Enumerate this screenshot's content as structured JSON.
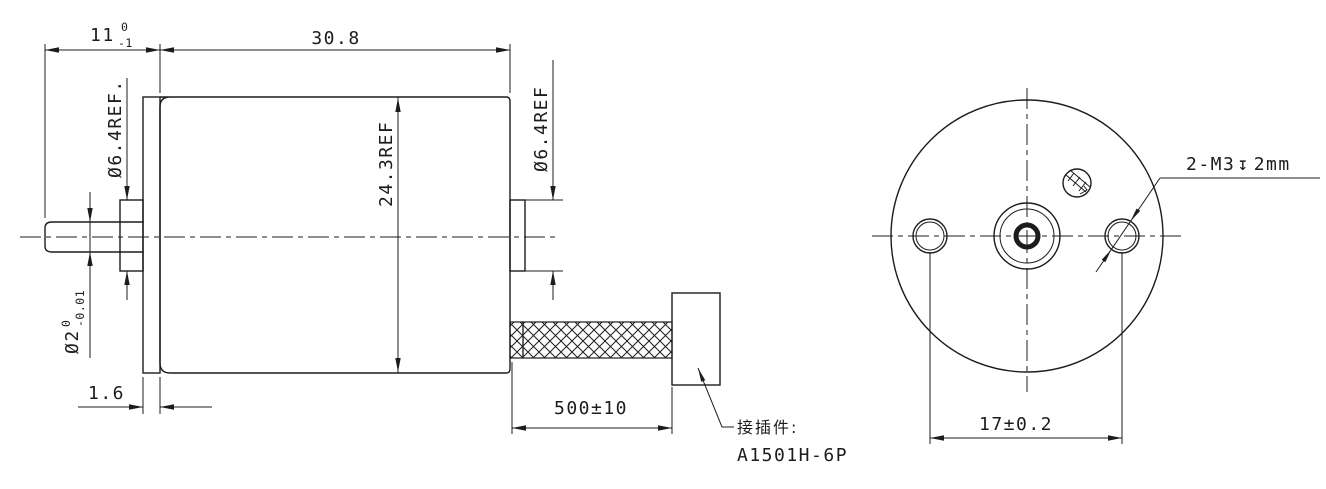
{
  "side_view": {
    "dim_shaft_protrusion": {
      "nominal": "11",
      "upper": "0",
      "lower": "-1"
    },
    "dim_body_length": "30.8",
    "dim_front_boss_dia": "Ø6.4REF.",
    "dim_body_dia": "24.3REF",
    "dim_rear_boss_dia": "Ø6.4REF",
    "dim_shaft_dia": {
      "nominal": "Ø2",
      "upper": "0",
      "lower": "-0.01"
    },
    "dim_flange_thickness": "1.6",
    "dim_lead_length": "500±10",
    "connector_note": {
      "label": "接插件:",
      "model": "A1501H-6P"
    }
  },
  "front_view": {
    "thread_callout": {
      "count_size": "2-M3",
      "depth_symbol": "↧",
      "depth": "2mm"
    },
    "dim_hole_spacing": "17±0.2"
  },
  "colors": {
    "line": "#1c1c1c",
    "background": "#ffffff"
  }
}
